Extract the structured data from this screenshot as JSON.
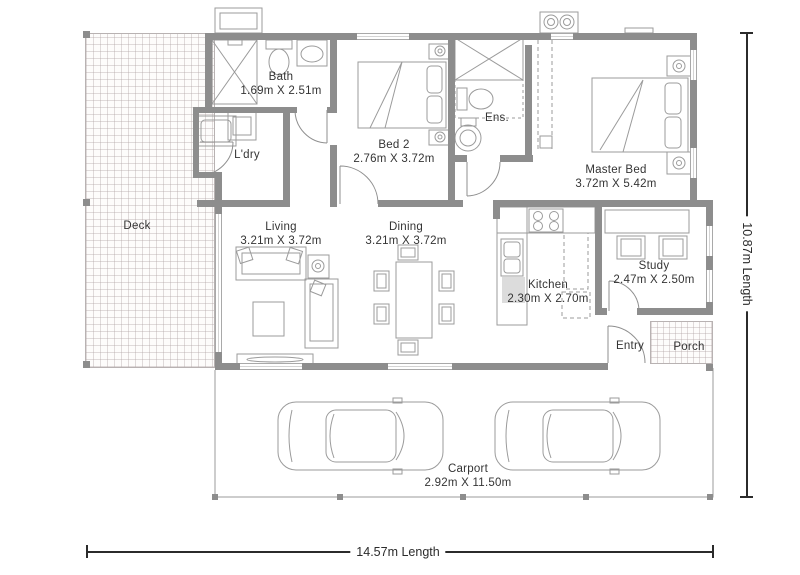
{
  "plan_type": "floorplan",
  "rooms": {
    "deck": {
      "label": "Deck",
      "dims": ""
    },
    "bath": {
      "label": "Bath",
      "dims": "1.69m X 2.51m"
    },
    "ldry": {
      "label": "L'dry",
      "dims": ""
    },
    "bed2": {
      "label": "Bed 2",
      "dims": "2.76m X 3.72m"
    },
    "ens": {
      "label": "Ens.",
      "dims": ""
    },
    "master": {
      "label": "Master Bed",
      "dims": "3.72m X 5.42m"
    },
    "living": {
      "label": "Living",
      "dims": "3.21m X 3.72m"
    },
    "dining": {
      "label": "Dining",
      "dims": "3.21m X 3.72m"
    },
    "kitchen": {
      "label": "Kitchen",
      "dims": "2.30m X 2.70m"
    },
    "study": {
      "label": "Study",
      "dims": "2.47m X 2.50m"
    },
    "entry": {
      "label": "Entry",
      "dims": ""
    },
    "porch": {
      "label": "Porch",
      "dims": ""
    },
    "carport": {
      "label": "Carport",
      "dims": "2.92m X 11.50m"
    }
  },
  "dimensions": {
    "bottom": "14.57m Length",
    "right": "10.87m Length"
  },
  "colors": {
    "wall": "#8d8d8d",
    "furniture_line": "#9b9b9b",
    "text": "#343434",
    "dimension": "#2b2b2b",
    "hatch": "#b8b2b2"
  }
}
